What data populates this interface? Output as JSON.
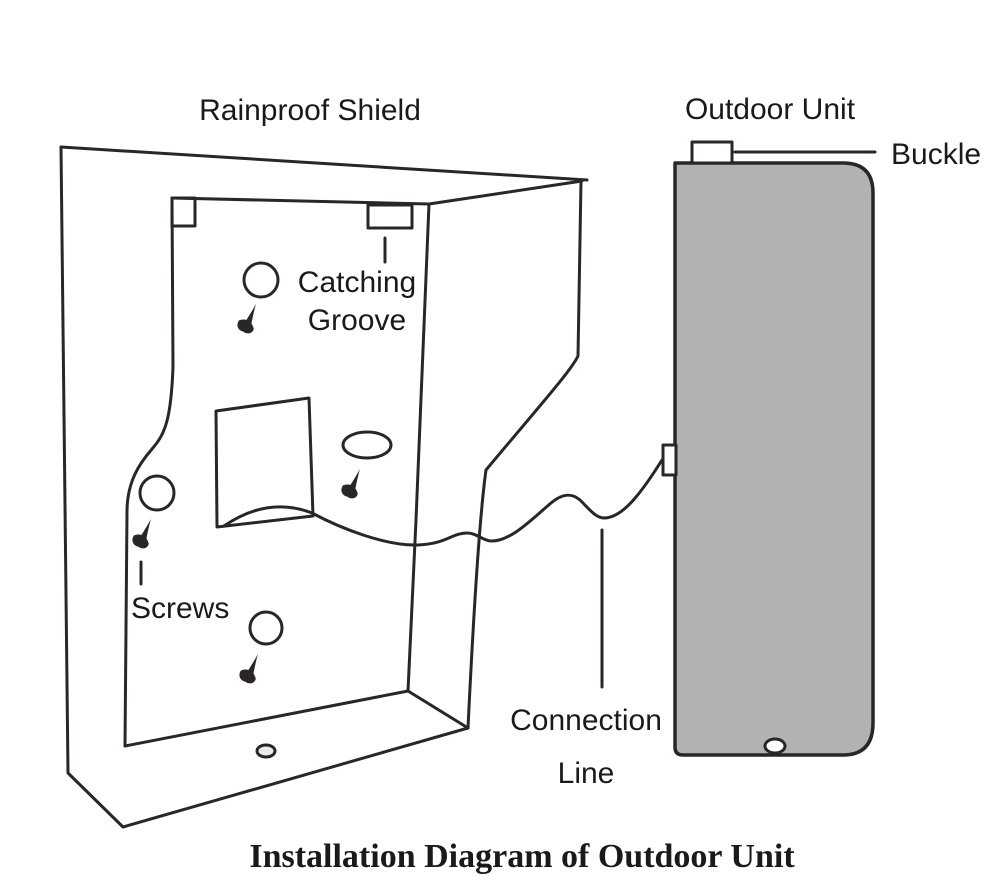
{
  "diagram": {
    "title": "Installation Diagram of Outdoor Unit",
    "labels": {
      "rainproof_shield": "Rainproof Shield",
      "outdoor_unit": "Outdoor Unit",
      "buckle": "Buckle",
      "catching_groove": {
        "line1": "Catching",
        "line2": "Groove"
      },
      "screws": "Screws",
      "connection_line": {
        "line1": "Connection",
        "line2": "Line"
      }
    },
    "colors": {
      "line": "#2a2628",
      "text": "#1a1a1a",
      "background": "#ffffff",
      "unit_fill": "#b2b2b2",
      "shield_hole_fill": "#ececec",
      "unit_hole_fill": "#ffffff",
      "tab_fill": "#ffffff"
    }
  }
}
